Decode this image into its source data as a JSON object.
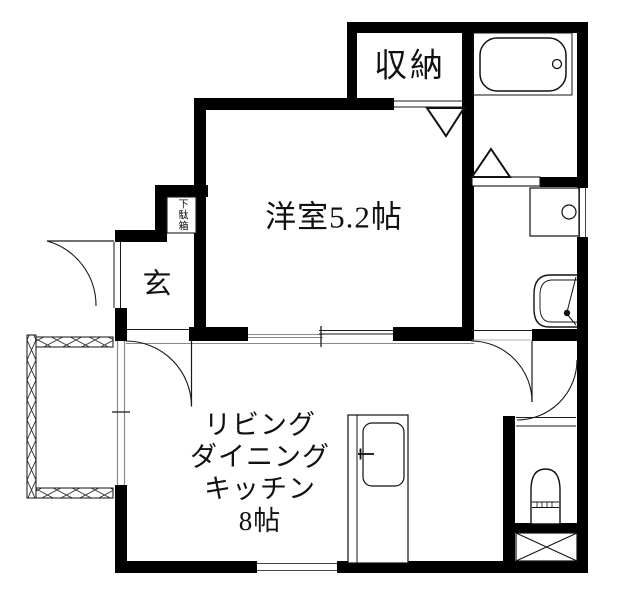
{
  "title": "apartment-floorplan",
  "labels": {
    "closet": "収納",
    "western_room": "洋室5.2帖",
    "entrance": "玄",
    "shoe_cabinet": "下駄箱",
    "ldk_line1": "リビング",
    "ldk_line2": "ダイニング",
    "ldk_line3": "キッチン",
    "ldk_line4": "8帖"
  },
  "colors": {
    "wall": "#000000",
    "line": "#1a1a1a",
    "window_line": "#8a8a8a",
    "background": "#ffffff",
    "text": "#111111"
  },
  "fixture_icons": [
    "bathtub-icon",
    "faucet-knob-icon",
    "washing-machine-pan-icon",
    "wash-basin-icon",
    "toilet-icon",
    "pipe-space-x-icon",
    "kitchen-sink-icon",
    "balcony-lattice-rail-icon",
    "door-swing-arc-icon",
    "folding-door-triangle-icon"
  ]
}
